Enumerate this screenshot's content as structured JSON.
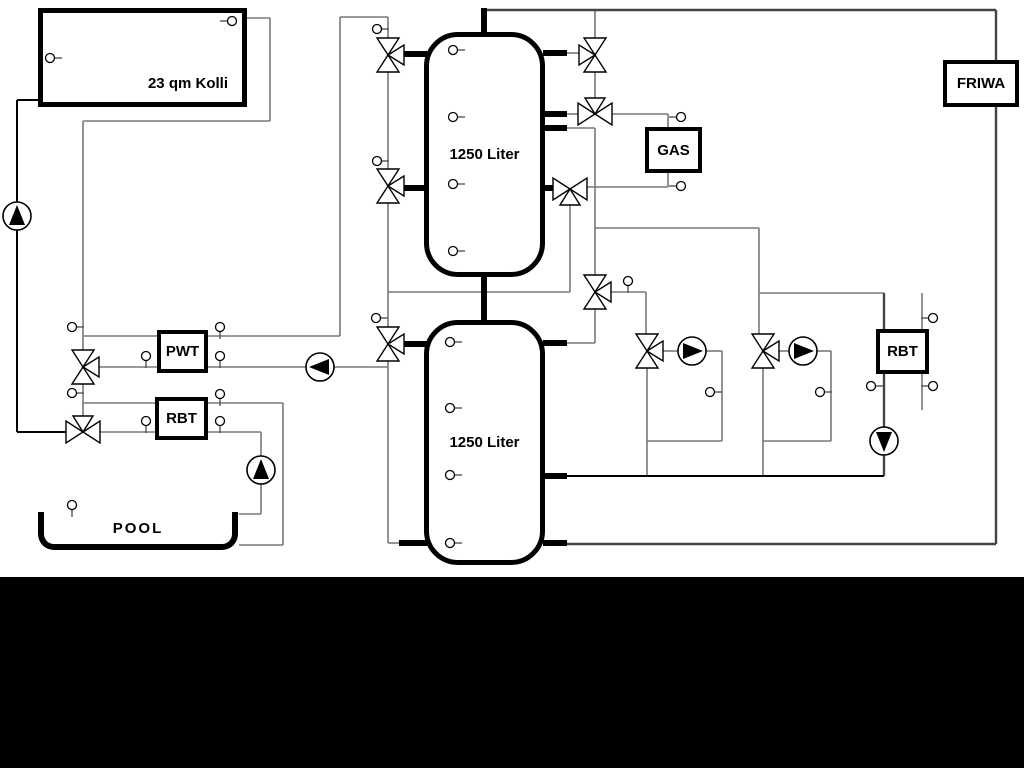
{
  "labels": {
    "collector": "23 qm Kolli",
    "tank_top": "1250 Liter",
    "tank_bottom": "1250 Liter",
    "pwt": "PWT",
    "rbt_left": "RBT",
    "gas": "GAS",
    "friwa": "FRIWA",
    "rbt_right": "RBT",
    "pool": "POOL"
  },
  "colors": {
    "background": "#ffffff",
    "outline_black": "#000000",
    "pipe_gray": "#787878",
    "pipe_dark": "#444444",
    "bottom_bar": "#000000"
  }
}
